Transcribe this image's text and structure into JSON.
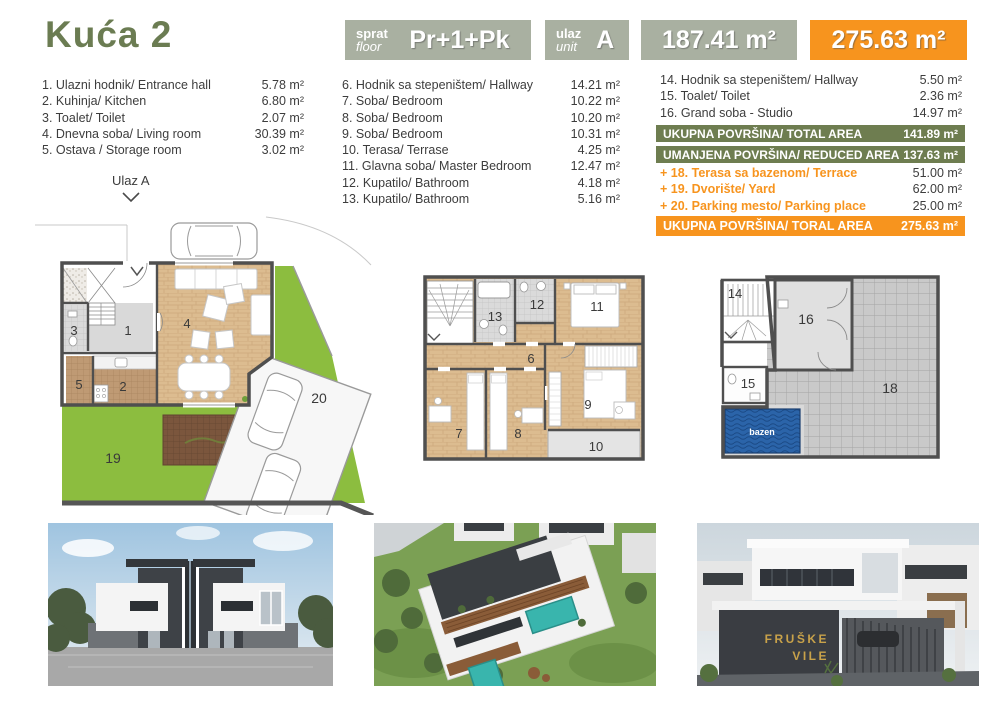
{
  "header": {
    "title": "Kuća 2",
    "floor_box": {
      "label_sr": "sprat",
      "label_en": "floor",
      "value": "Pr+1+Pk"
    },
    "unit_box": {
      "label_sr": "ulaz",
      "label_en": "unit",
      "value": "A"
    },
    "area_box": {
      "value": "187.41 m²"
    },
    "total_box": {
      "value": "275.63 m²"
    }
  },
  "rooms": {
    "col1": [
      {
        "label": "1. Ulazni hodnik/ Entrance hall",
        "area": "5.78 m²"
      },
      {
        "label": "2. Kuhinja/ Kitchen",
        "area": "6.80 m²"
      },
      {
        "label": "3. Toalet/ Toilet",
        "area": "2.07 m²"
      },
      {
        "label": "4. Dnevna soba/ Living room",
        "area": "30.39 m²"
      },
      {
        "label": "5. Ostava / Storage room",
        "area": "3.02 m²"
      }
    ],
    "col2": [
      {
        "label": "6. Hodnik sa stepeništem/ Hallway",
        "area": "14.21 m²"
      },
      {
        "label": "7. Soba/ Bedroom",
        "area": "10.22 m²"
      },
      {
        "label": "8. Soba/ Bedroom",
        "area": "10.20 m²"
      },
      {
        "label": "9. Soba/ Bedroom",
        "area": "10.31 m²"
      },
      {
        "label": "10. Terasa/ Terrase",
        "area": "4.25 m²"
      },
      {
        "label": "11. Glavna soba/ Master Bedroom",
        "area": "12.47 m²"
      },
      {
        "label": "12. Kupatilo/ Bathroom",
        "area": "4.18 m²"
      },
      {
        "label": "13. Kupatilo/ Bathroom",
        "area": "5.16 m²"
      }
    ],
    "col3": [
      {
        "label": "14. Hodnik sa stepeništem/ Hallway",
        "area": "5.50 m²"
      },
      {
        "label": "15. Toalet/ Toilet",
        "area": "2.36 m²"
      },
      {
        "label": "16. Grand soba - Studio",
        "area": "14.97 m²"
      }
    ]
  },
  "totals": {
    "total_area": {
      "label": "UKUPNA POVRŠINA/ TOTAL AREA",
      "value": "141.89 m²"
    },
    "reduced_area": {
      "label": "UMANJENA POVRŠINA/ REDUCED AREA",
      "value": "137.63 m²"
    },
    "extras": [
      {
        "label": "+ 18. Terasa sa bazenom/ Terrace",
        "value": "51.00 m²"
      },
      {
        "label": "+ 19. Dvorište/ Yard",
        "value": "62.00 m²"
      },
      {
        "label": "+ 20. Parking mesto/ Parking place",
        "value": "25.00 m²"
      }
    ],
    "grand_total": {
      "label": "UKUPNA POVRŠINA/ TORAL AREA",
      "value": "275.63 m²"
    }
  },
  "plans": {
    "entrance_label": "Ulaz A",
    "ground_labels": {
      "hall": "1",
      "kitchen": "2",
      "toilet": "3",
      "living": "4",
      "storage": "5",
      "yard": "19",
      "parking": "20"
    },
    "first_labels": {
      "hallway": "6",
      "bed7": "7",
      "bed8": "8",
      "bed9": "9",
      "terrace": "10",
      "master": "11",
      "bath12": "12",
      "bath13": "13"
    },
    "attic_labels": {
      "hall": "14",
      "toilet": "15",
      "studio": "16",
      "terrace": "18",
      "pool": "bazen"
    }
  },
  "photos": {
    "sign_line1": "FRUŠKE",
    "sign_line2": "VILE"
  },
  "colors": {
    "accent_orange": "#f7941e",
    "header_box_green": "#a9b0a1",
    "bar_green": "#6e7d50",
    "title_green": "#6b7c52",
    "yard_green": "#8cbd3f",
    "pool_blue": "#2b64a9",
    "sign_gold": "#c8a24a"
  }
}
